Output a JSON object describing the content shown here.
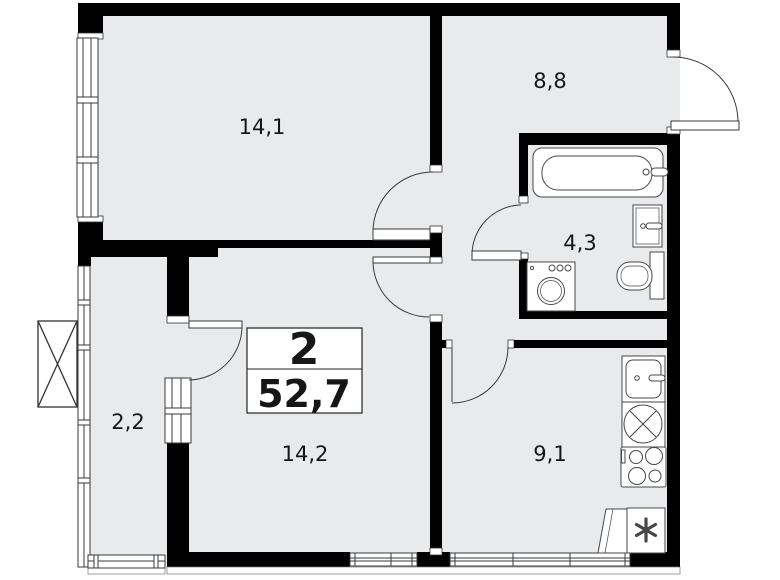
{
  "plan": {
    "summary": {
      "room_count": "2",
      "total_area": "52,7"
    },
    "rooms": [
      {
        "name": "room-14-1",
        "area": "14,1"
      },
      {
        "name": "hallway",
        "area": "8,8"
      },
      {
        "name": "bathroom",
        "area": "4,3"
      },
      {
        "name": "balcony",
        "area": "2,2"
      },
      {
        "name": "living-room",
        "area": "14,2"
      },
      {
        "name": "kitchen",
        "area": "9,1"
      }
    ],
    "fixtures": [
      "bathtub",
      "washbasin",
      "toilet",
      "washing-machine",
      "kitchen-sink",
      "hob",
      "stove",
      "refrigerator"
    ],
    "colors": {
      "wall": "#000000",
      "floor": "#e8eaec",
      "background": "#ffffff",
      "line": "#3a3a3a"
    }
  }
}
